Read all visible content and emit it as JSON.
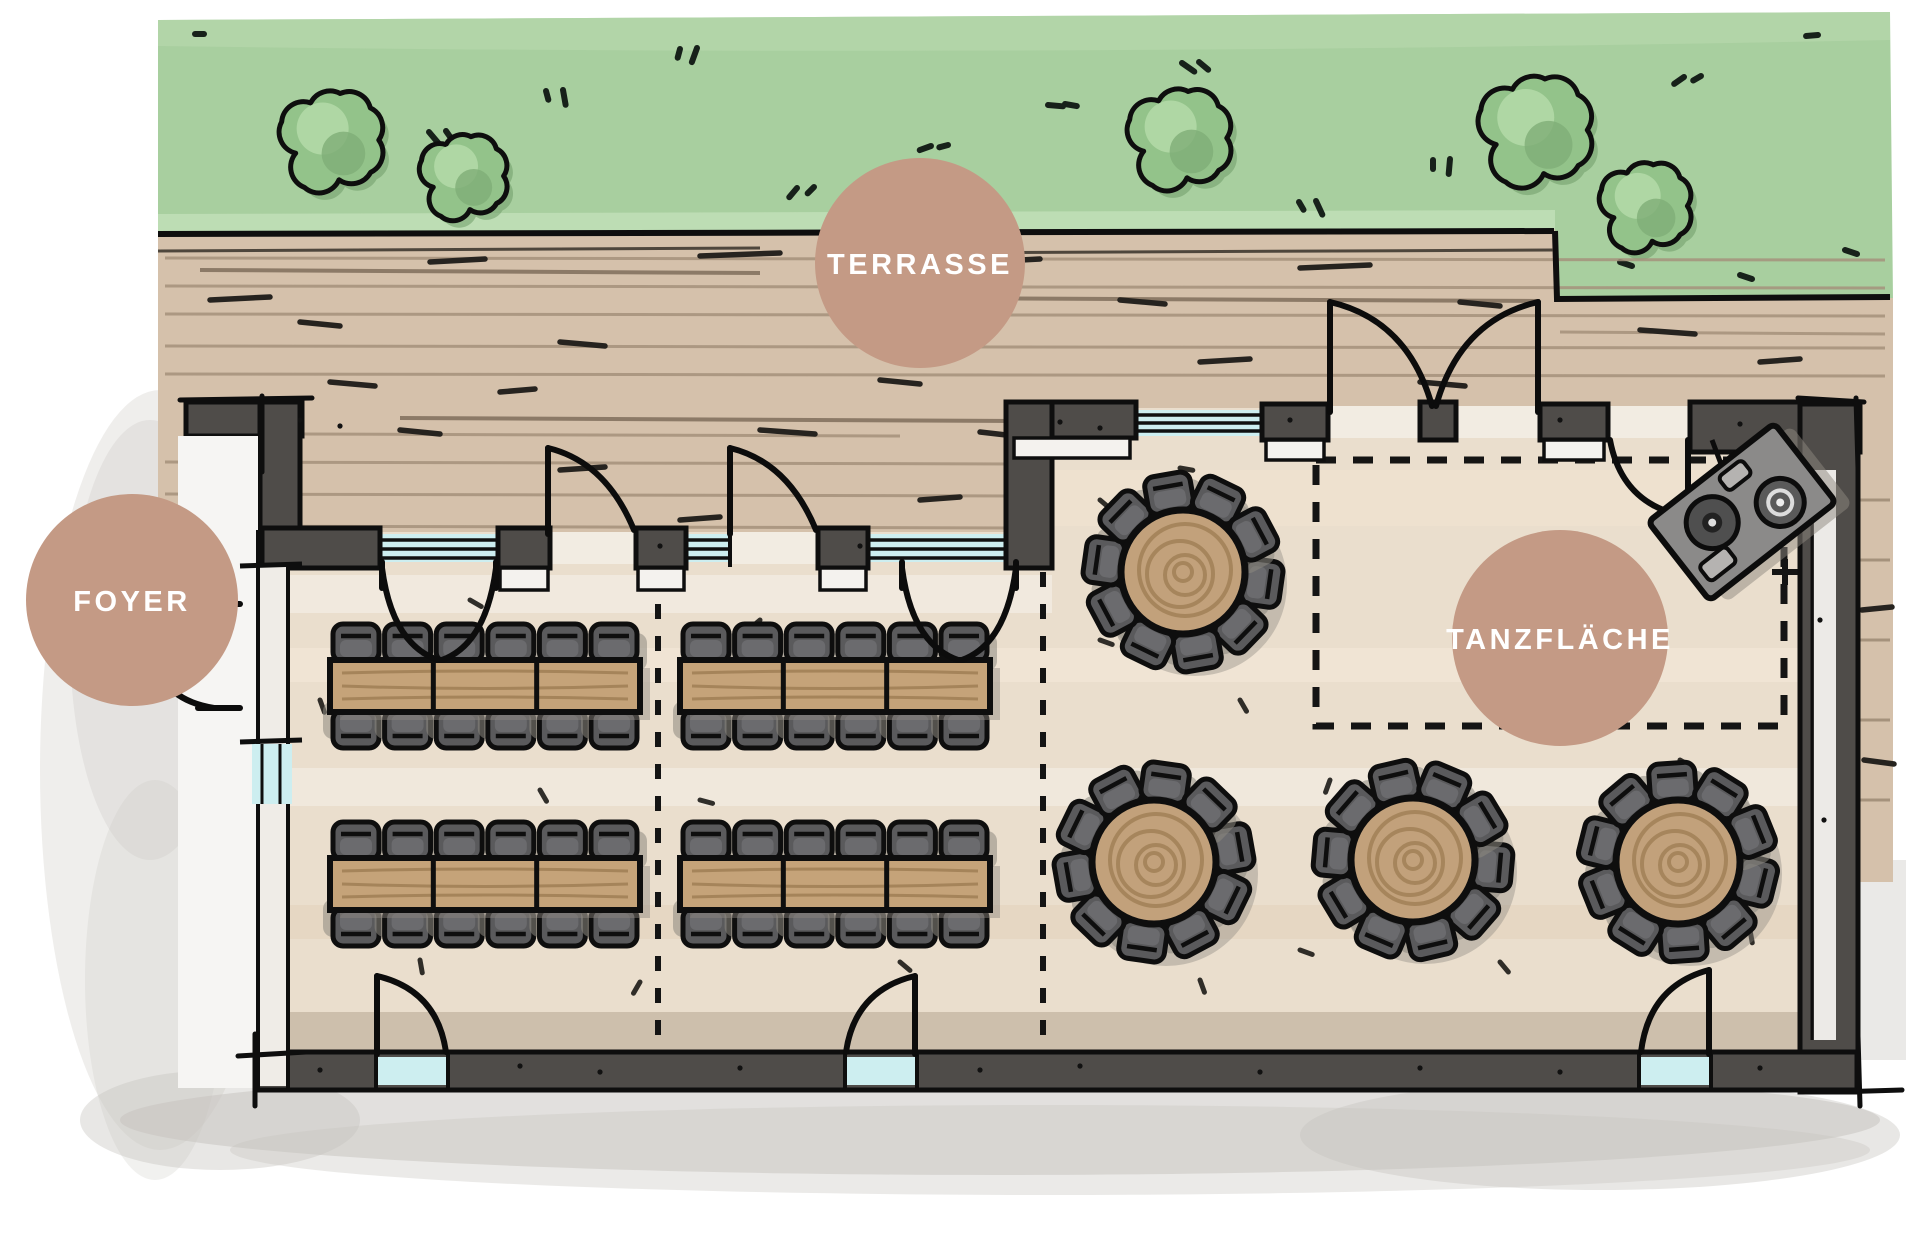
{
  "labels": {
    "terrace": "TERRASSE",
    "foyer": "FOYER",
    "dance_floor": "TANZFLÄCHE"
  },
  "colors": {
    "badge": "#c49a85",
    "badge_text": "#ffffff",
    "grass": "#a8cf9f",
    "bush": "#93c38a",
    "deck_wood": "#d5c1ab",
    "interior_floor": "#eadecd",
    "wall": "#4f4c49",
    "outline": "#0e0e0e",
    "window_glass": "#cdeef0",
    "table_wood": "#c5a379",
    "chair": "#5a5a5c",
    "shadow": "#c9c6c1"
  },
  "floor_plan": {
    "areas": [
      {
        "id": "terrasse",
        "label": "TERRASSE",
        "type": "outdoor wood deck with lawn"
      },
      {
        "id": "foyer",
        "label": "FOYER",
        "type": "entrance area outside left wall"
      },
      {
        "id": "tanzflaeche",
        "label": "TANZFLÄCHE",
        "type": "dance floor marked by dashed outline"
      }
    ],
    "furniture": {
      "long_tables": 4,
      "seats_per_long_table": 12,
      "round_tables": 4,
      "seats_per_round_table": 10,
      "dj_turntable_booths": 1
    },
    "landscape": {
      "bushes": 5,
      "lawn_strips": 1
    }
  },
  "icons": {
    "dj_booth": "dj-turntable-icon",
    "bush": "bush-icon",
    "door": "door-swing-arc-icon",
    "window": "window-triple-line-icon",
    "dance_floor_marker": "plus-marker-icon"
  }
}
